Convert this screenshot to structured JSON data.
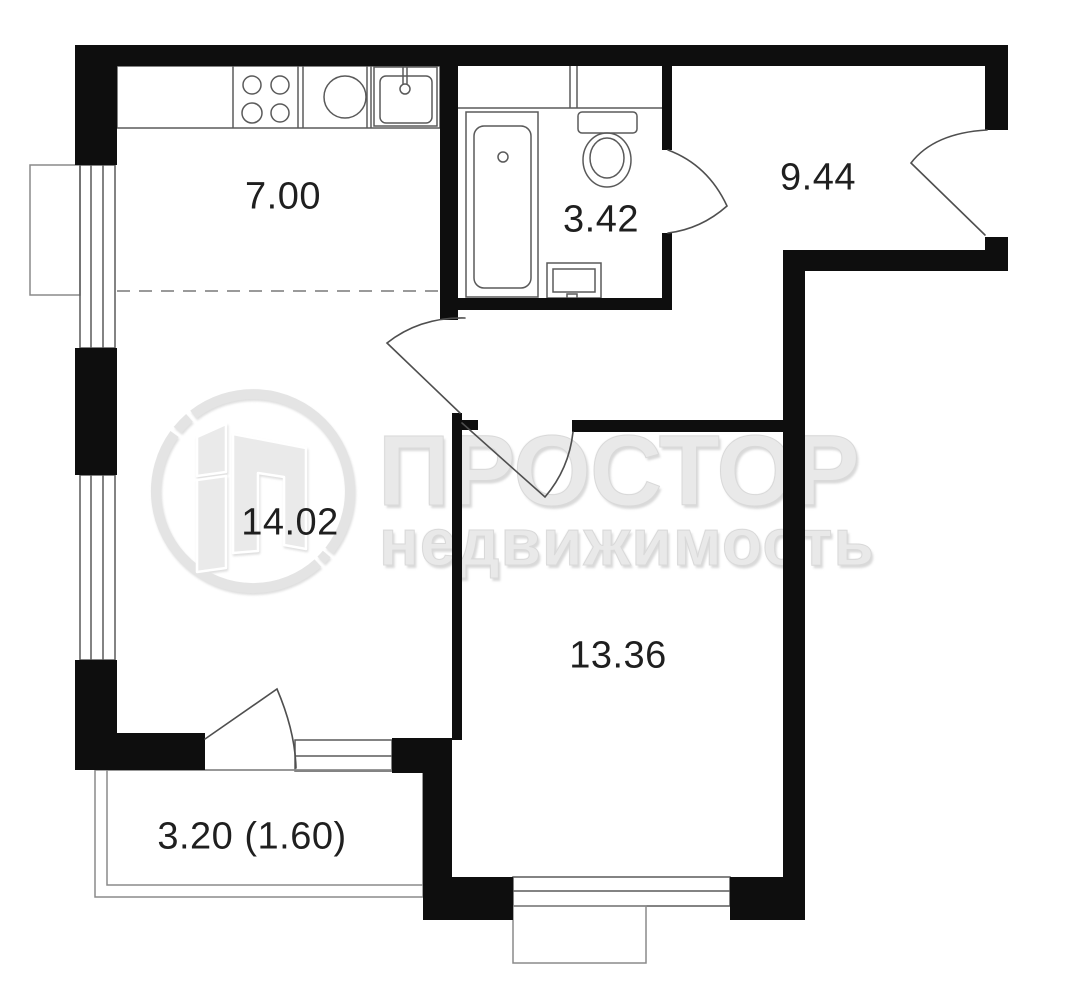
{
  "watermark": {
    "brand": "ПРОСТОР",
    "brand_sub": "недвижимость",
    "logo": "prostor-realty-circle-logo"
  },
  "rooms": [
    {
      "name": "kitchen",
      "area_label": "7.00"
    },
    {
      "name": "bathroom",
      "area_label": "3.42"
    },
    {
      "name": "hallway",
      "area_label": "9.44"
    },
    {
      "name": "living-room",
      "area_label": "14.02"
    },
    {
      "name": "bedroom",
      "area_label": "13.36"
    },
    {
      "name": "balcony",
      "area_label": "3.20 (1.60)"
    }
  ],
  "colors": {
    "wall": "#0e0e0e",
    "thin_line": "#5a5a5a",
    "light_line": "#8a8a8a",
    "dashed_line": "#9a9a9a",
    "label_text": "#1f1f1f",
    "watermark_gray": "#e9e9e9"
  }
}
